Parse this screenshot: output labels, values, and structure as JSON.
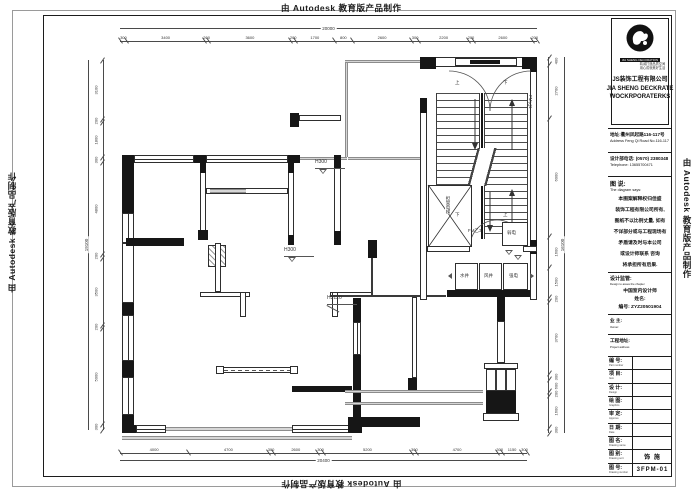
{
  "watermark": {
    "text": "由 Autodesk 教育版产品制作"
  },
  "title_block": {
    "logo": {
      "banner": "JIA SHENG DECORATION",
      "tagline1": "精诚打造品质空间",
      "tagline2": "用心成就美好生活",
      "company_cn": "JS装饰工程有限公司",
      "company_en1": "JIA SHENG DECKRATE",
      "company_en2": "WOCKRPORATERKS"
    },
    "address_cn": "地址:衢州凤起路116-117号",
    "address_en": "Address Feng Qi Road No.116-117",
    "phone_cn": "设计部电话: (0570) 2380348",
    "phone_en": "Telephone: 13655700471",
    "notes_title": "图 说:",
    "notes_subtitle": "The diagram says:",
    "notes_lines": [
      "本图案解释权归佳盛",
      "装饰工程有限公司所有,",
      "图纸不以比例丈量, 如有",
      "不详部分或与工程现场有",
      "矛盾请及时与本公司",
      "或设计师联系 咨询",
      "将承担所有后果."
    ],
    "supervision_title": "设计监管:",
    "supervision_subtitle": "Design to asses the chapter",
    "supervision_lines": [
      "中国室内设计师",
      "姓名:",
      "编号: ZYZ20501904"
    ],
    "owner_label": "业 主:",
    "owner_sub": "Owner:",
    "site_label": "工程地址:",
    "site_sub": "Project address",
    "rows": [
      {
        "label": "编 号:",
        "sub": "Part number",
        "value": ""
      },
      {
        "label": "项 目:",
        "sub": "Item",
        "value": ""
      },
      {
        "label": "设 计:",
        "sub": "Design",
        "value": ""
      },
      {
        "label": "绘 图:",
        "sub": "Graphics",
        "value": ""
      },
      {
        "label": "审 定:",
        "sub": "Approve",
        "value": ""
      },
      {
        "label": "日 期:",
        "sub": "Date",
        "value": ""
      },
      {
        "label": "图 名:",
        "sub": "Drawing name",
        "value": ""
      },
      {
        "label": "图 别:",
        "sub": "Drawing sort",
        "value": "饰 施"
      },
      {
        "label": "图 号:",
        "sub": "Drawing number",
        "value": "3FPM-01"
      }
    ]
  },
  "plan": {
    "dims": {
      "top_overall": "20000",
      "top": [
        300,
        3400,
        200,
        3600,
        200,
        1700,
        800,
        2600,
        300,
        2200,
        200,
        2600,
        200
      ],
      "bottom_overall": "20400",
      "bottom": [
        4000,
        4700,
        300,
        2600,
        300,
        5200,
        300,
        4700,
        300,
        1150,
        300
      ],
      "left_overall": "19100",
      "left": [
        3100,
        200,
        1800,
        300,
        4800,
        200,
        3500,
        200,
        5000,
        300
      ],
      "right_overall": "16100",
      "right": [
        400,
        2700,
        6000,
        1600,
        1500,
        200,
        3700,
        300,
        600,
        200,
        1600,
        300
      ]
    },
    "labels": {
      "h300a": "H300",
      "h300b": "H300",
      "h3120": "H3120",
      "door_fm1": "FM乙1",
      "door_fm3": "FM乙3",
      "elevator": "担架电梯",
      "weak_power": "弱电",
      "water_shaft": "水井",
      "air_shaft": "风井",
      "strong_power": "强电",
      "up1": "上",
      "down1": "下",
      "down2": "下",
      "up2": "上"
    }
  }
}
